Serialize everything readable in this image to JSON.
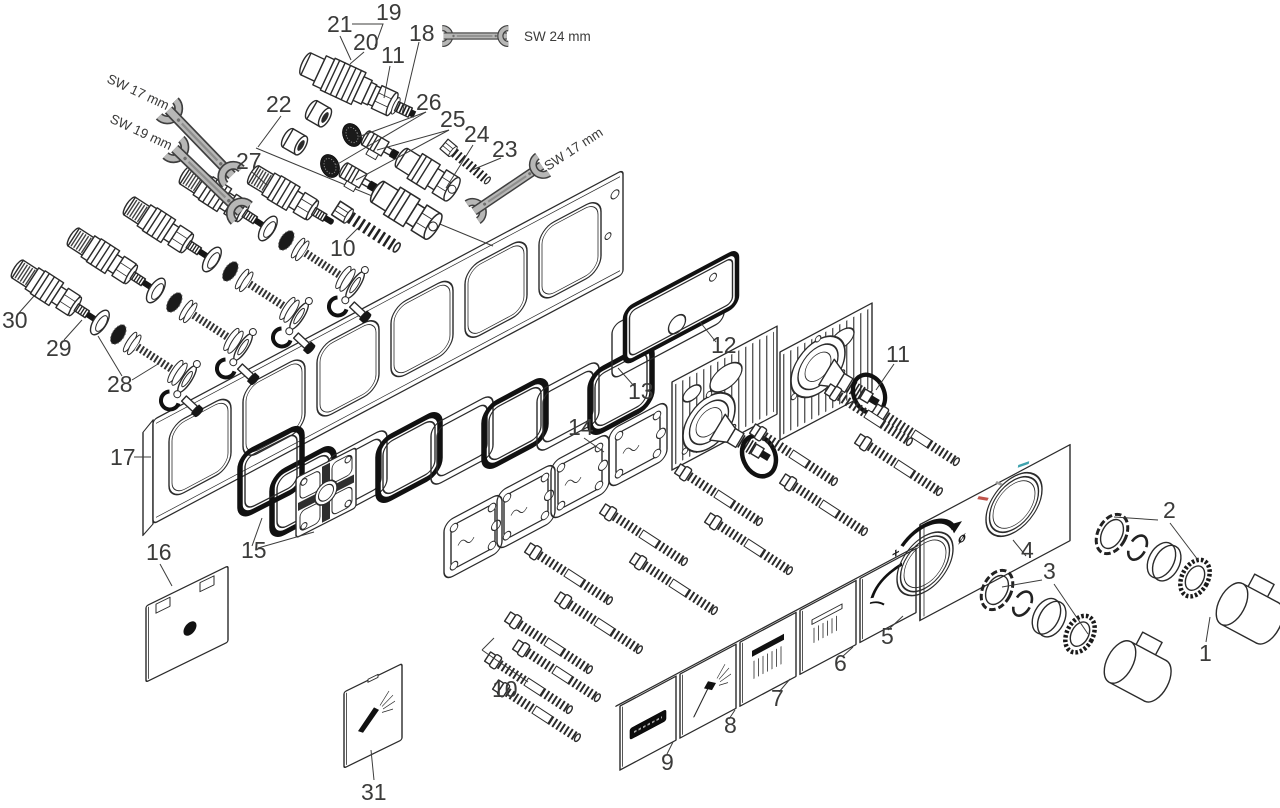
{
  "title": "Thermostatic valve exploded parts diagram",
  "callouts": {
    "c1": "1",
    "c2": "2",
    "c3": "3",
    "c4": "4",
    "c5": "5",
    "c6": "6",
    "c7": "7",
    "c8": "8",
    "c9": "9",
    "c10": "10",
    "c10b": "10",
    "c11": "11",
    "c11b": "11",
    "c12": "12",
    "c13": "13",
    "c14": "14",
    "c15": "15",
    "c16": "16",
    "c17": "17",
    "c18": "18",
    "c19": "19",
    "c20": "20",
    "c21": "21",
    "c22": "22",
    "c23": "23",
    "c24": "24",
    "c25": "25",
    "c26": "26",
    "c27": "27",
    "c28": "28",
    "c29": "29",
    "c30": "30",
    "c31": "31"
  },
  "tools": {
    "sw24": "SW 24 mm",
    "sw17_left": "SW 17 mm",
    "sw19_left": "SW 19 mm",
    "sw17_right": "SW 17 mm"
  },
  "faceplate": {
    "plus": "+",
    "off": "ø"
  },
  "colors": {
    "line": "#2b2b2b",
    "label": "#3b3b3a",
    "tool_gray": "#b7b7b6",
    "dark_part": "#161616",
    "hot_red": "#c0544b",
    "cold_teal": "#3fa3ad",
    "background": "#ffffff"
  }
}
